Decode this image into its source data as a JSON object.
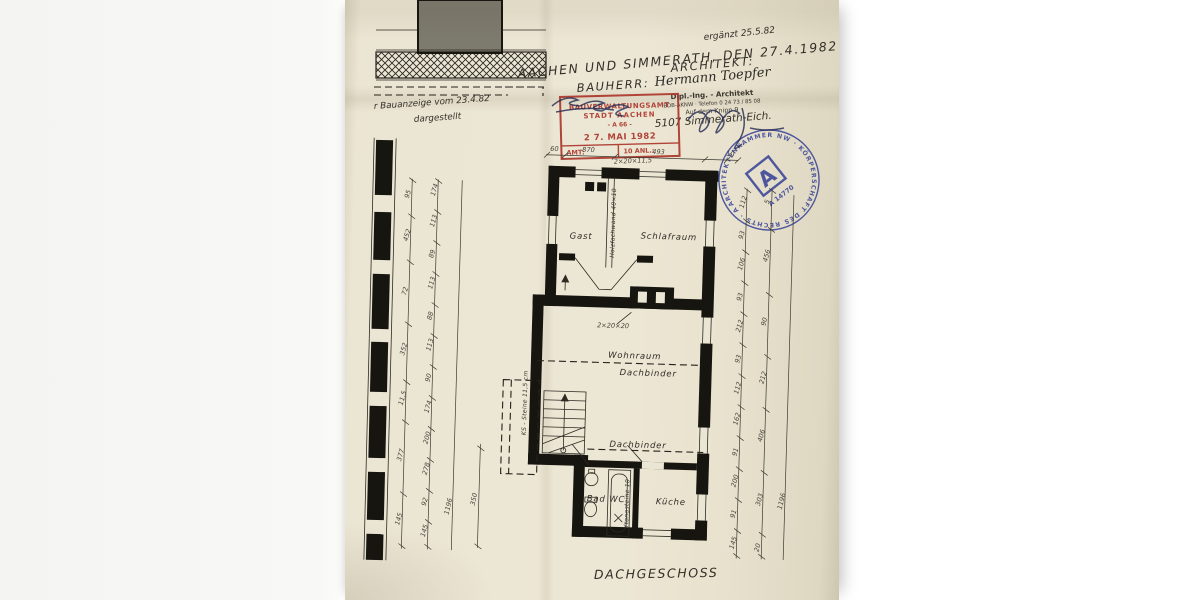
{
  "header": {
    "amendment_note": "ergänzt 25.5.82",
    "place_date_line": "AACHEN UND SIMMERATH, DEN 27.4.1982",
    "bauherr_label": "BAUHERR:",
    "architekt_label": "ARCHITEKT:",
    "architect_name": "Hermann Toepfer",
    "architect_title": "Dipl.-Ing. - Architekt",
    "architect_assoc_phone": "BDB-AKNW · Telefon 0 24 73 / 85 08",
    "architect_street": "Auf dem Knipp 9",
    "architect_city": "5107 Simmerath-Eich.",
    "left_note_line1": "r Bauanzeige vom 23.4.82",
    "left_note_line2": "dargestellt"
  },
  "stamps": {
    "red": {
      "line1": "BAUVERWALTUNGSAMT",
      "line2": "STADT AACHEN",
      "line3": "- A 66 -",
      "date": "2 7. MAI 1982",
      "amt_label": "AMT:",
      "anl_label": "10 ANL.:",
      "color": "#ad372c"
    },
    "blue": {
      "ring_text": "ARCHITEKTENKAMMER NW · KÖRPERSCHAFT DES RECHTS · ARCHITEKT ·",
      "logo_letter": "A",
      "number": "A 14770",
      "color": "#2d3a95"
    }
  },
  "plan": {
    "title": "DACHGESCHOSS",
    "rooms": {
      "gast": "Gast",
      "schlafraum": "Schlafraum",
      "wohnraum": "Wohnraum",
      "bad": "Bad WC",
      "kueche": "Küche"
    },
    "labels": {
      "dachbinder_upper": "Dachbinder",
      "dachbinder_lower": "Dachbinder",
      "holzfachwand": "Holzfachwand 40×10",
      "ks_steine": "KS - Steine 11,5 cm",
      "ytongsteine": "Ytongsteine 10",
      "chimney": "2×20×20",
      "top_wall": "2×20×11,5"
    }
  },
  "dims": {
    "top": [
      "60",
      "870",
      "493",
      "10"
    ],
    "left_outer": [
      "95",
      "452",
      "72",
      "352",
      "11,5",
      "377",
      "145"
    ],
    "left_inner": [
      "174",
      "113",
      "89",
      "113",
      "88",
      "113",
      "90",
      "174",
      "200",
      "278",
      "92",
      "145"
    ],
    "left_total": "1196",
    "right_inner": [
      "112",
      "93",
      "106",
      "93",
      "212",
      "93",
      "112",
      "162",
      "91",
      "200",
      "91",
      "145"
    ],
    "right_outer": [
      "5",
      "456",
      "90",
      "212",
      "406",
      "303",
      "20"
    ],
    "right_total": "1196",
    "bad_height": "350"
  }
}
